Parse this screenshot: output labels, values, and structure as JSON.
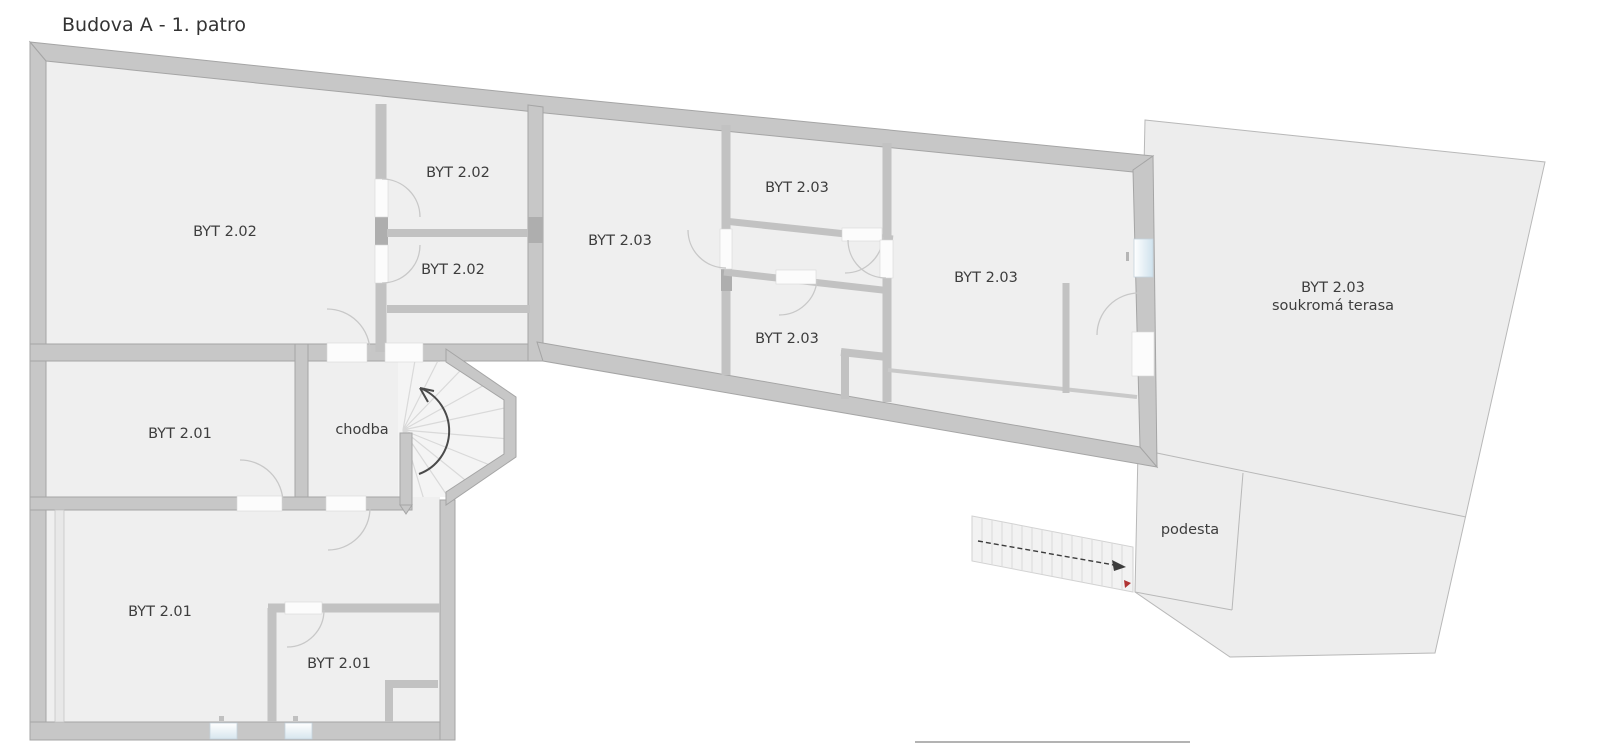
{
  "title": "Budova A - 1. patro",
  "room_labels": {
    "byt202_main": "BYT 2.02",
    "byt202_room1": "BYT 2.02",
    "byt202_room2": "BYT 2.02",
    "byt203_main": "BYT 2.03",
    "byt203_upper": "BYT 2.03",
    "byt203_lower": "BYT 2.03",
    "byt203_right": "BYT 2.03",
    "byt201_upper": "BYT 2.01",
    "byt201_main": "BYT 2.01",
    "byt201_small": "BYT 2.01",
    "chodba": "chodba",
    "terrace_line1": "BYT 2.03",
    "terrace_line2": "soukromá terasa",
    "podesta": "podesta"
  },
  "colors": {
    "wall": "#c7c7c7",
    "wall_edge": "#a5a5a5",
    "room_fill": "#efefef",
    "terrace_fill": "#ededed",
    "window_glass": "#d7e6ef",
    "stair_fill": "#f3f3f3",
    "direction_arrow": "#4a4a4a",
    "stair_end_marker": "#b03434"
  }
}
